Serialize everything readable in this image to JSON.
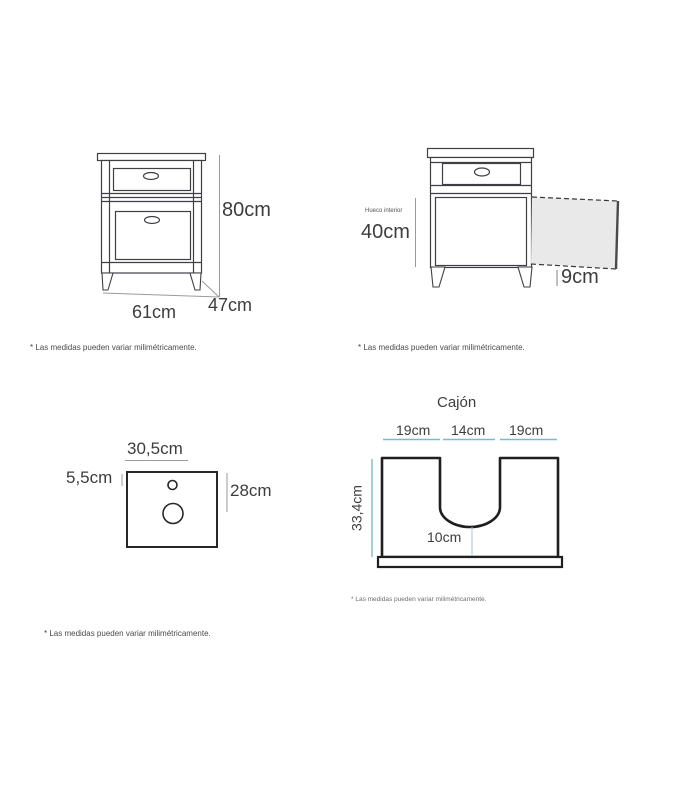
{
  "front_view": {
    "height": "80cm",
    "width": "61cm",
    "depth": "47cm",
    "disclaimer": "* Las medidas pueden variar milimétricamente."
  },
  "interior_view": {
    "label": "Hueco interior",
    "interior_height": "40cm",
    "door_depth": "9cm",
    "disclaimer": "* Las medidas pueden variar milimétricamente."
  },
  "countertop_view": {
    "width": "30,5cm",
    "faucet_offset": "5,5cm",
    "depth": "28cm",
    "disclaimer": "* Las medidas pueden variar milimétricamente."
  },
  "drawer_view": {
    "title": "Cajón",
    "left_width": "19cm",
    "notch_width": "14cm",
    "right_width": "19cm",
    "height": "33,4cm",
    "notch_bottom": "10cm",
    "disclaimer": "* Las medidas pueden variar milimétricamente."
  },
  "colors": {
    "line": "#3f3f45",
    "dim_line": "#9a9a9a",
    "accent_teal": "#7db8cb",
    "door_fill": "#e9e9e9",
    "text": "#3d3d3d"
  }
}
